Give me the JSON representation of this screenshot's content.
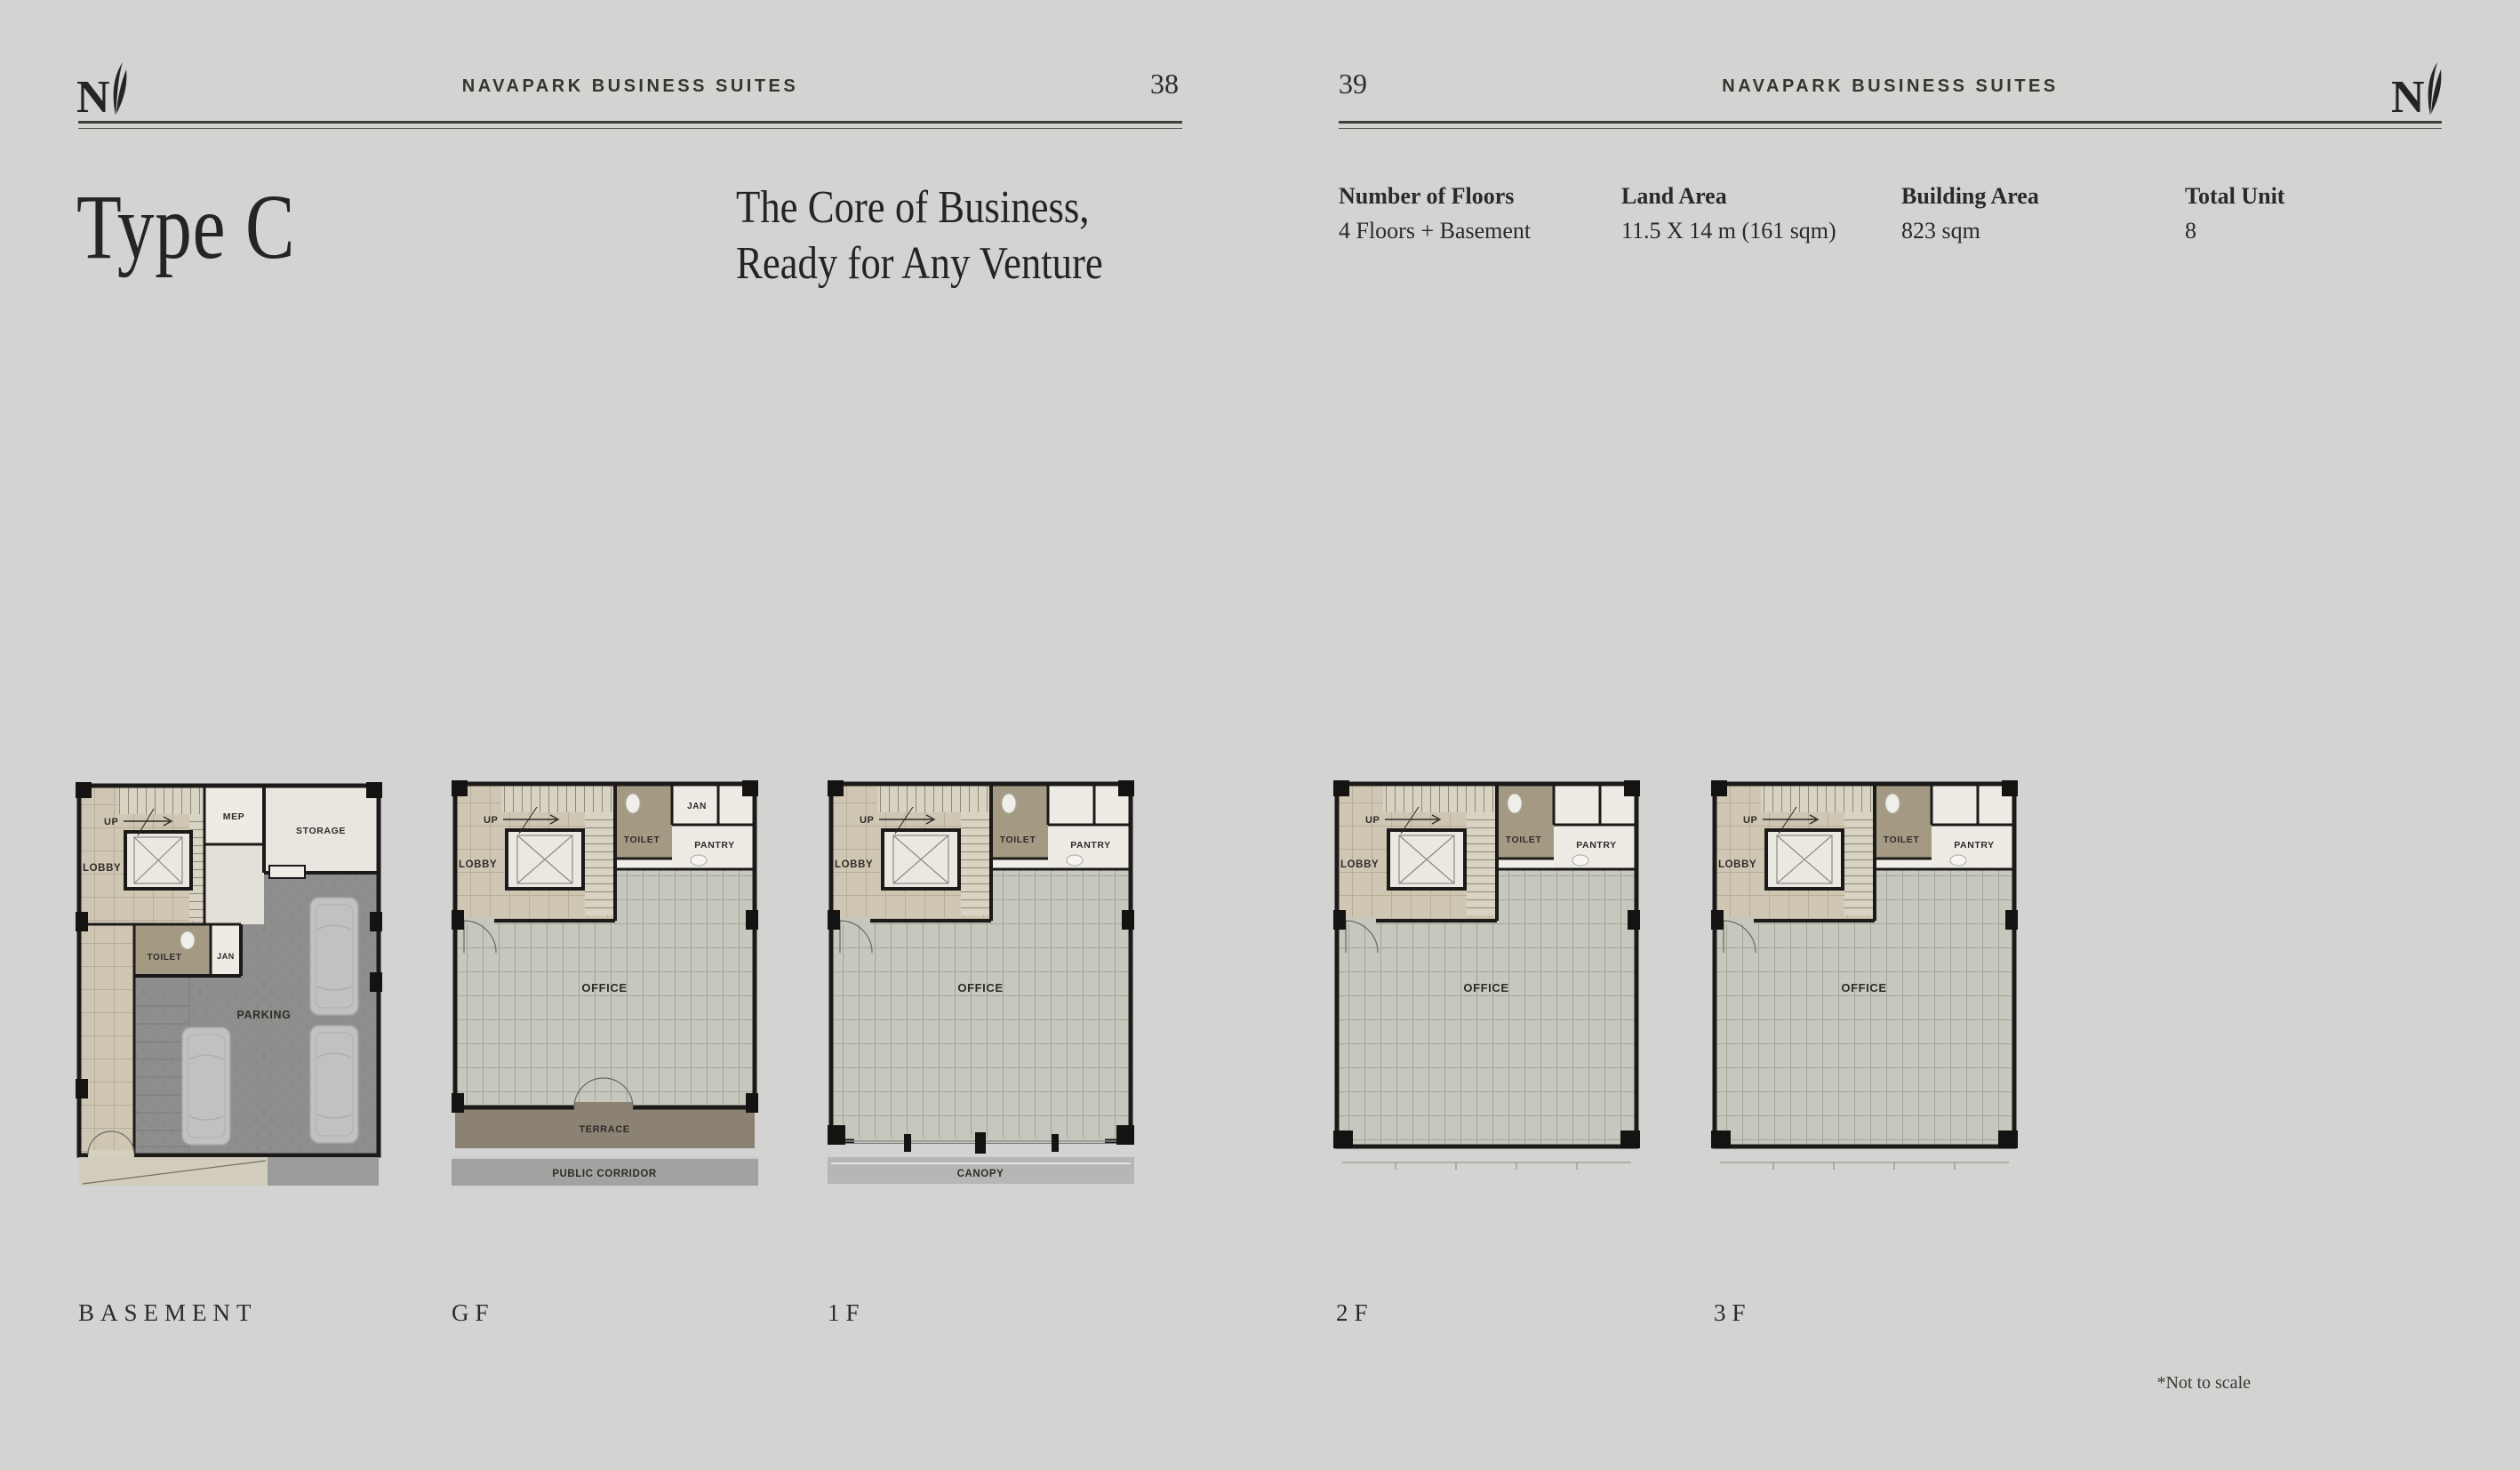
{
  "header_left": {
    "brand": "NAVAPARK BUSINESS SUITES",
    "page_number": "38"
  },
  "header_right": {
    "brand": "NAVAPARK BUSINESS SUITES",
    "page_number": "39"
  },
  "title": "Type C",
  "tagline": {
    "line1": "The Core of Business,",
    "line2": "Ready for Any Venture"
  },
  "specs": [
    {
      "label": "Number of Floors",
      "value": "4 Floors + Basement"
    },
    {
      "label": "Land Area",
      "value": "11.5 X 14 m (161 sqm)"
    },
    {
      "label": "Building Area",
      "value": "823 sqm"
    },
    {
      "label": "Total Unit",
      "value": "8"
    }
  ],
  "floors": [
    {
      "id": "basement",
      "label": "BASEMENT"
    },
    {
      "id": "gf",
      "label": "GF"
    },
    {
      "id": "f1",
      "label": "1F"
    },
    {
      "id": "f2",
      "label": "2F"
    },
    {
      "id": "f3",
      "label": "3F"
    }
  ],
  "plan_labels": {
    "up": "UP",
    "lobby": "LOBBY",
    "mep": "MEP",
    "storage": "STORAGE",
    "toilet": "TOILET",
    "jan": "JAN",
    "parking": "PARKING",
    "pantry": "PANTRY",
    "office": "OFFICE",
    "terrace": "TERRACE",
    "public_corridor": "PUBLIC CORRIDOR",
    "canopy": "CANOPY"
  },
  "footnote": "*Not to scale",
  "palette": {
    "paper": "#d3d3d2",
    "ink": "#2b2a28",
    "wall": "#1c1a19",
    "lobby_beige": "#cfc7b3",
    "office_floor": "#c7c8bd",
    "toilet_olive": "#a49a83",
    "room_white": "#edebe4",
    "parking_gray": "#8e8e8c",
    "terrace_brown": "#8b8274",
    "corridor_gray": "#a2a2a0",
    "canopy_gray": "#b6b6b4",
    "car_gray": "#bfc1c3"
  }
}
